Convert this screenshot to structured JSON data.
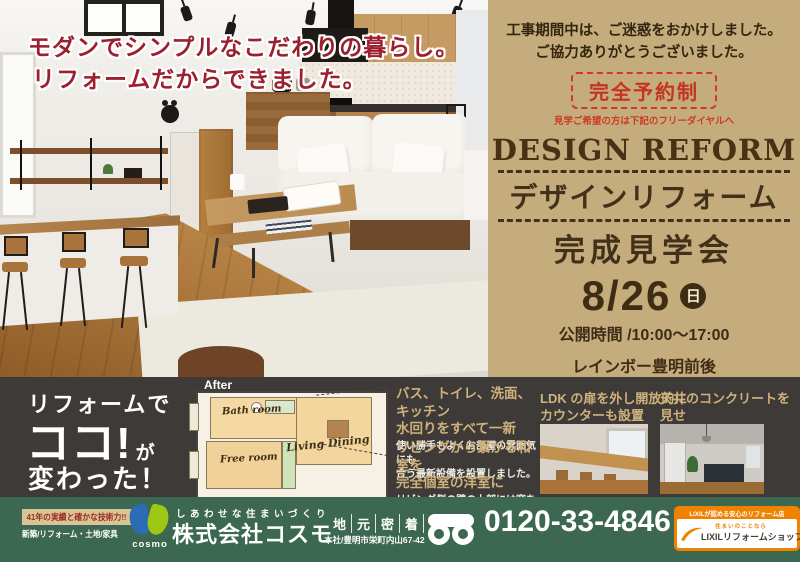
{
  "headline": {
    "line1": "モダンでシンプルなこだわりの暮らし。",
    "line2": "リフォームだからできました。"
  },
  "event_panel": {
    "greeting_line1": "工事期間中は、ご迷惑をおかけしました。",
    "greeting_line2": "ご協力ありがとうございました。",
    "reservation_badge": "完全予約制",
    "reservation_note": "見学ご希望の方は下記のフリーダイヤルへ",
    "title_en": "DESIGN REFORM",
    "title_jp": "デザインリフォーム",
    "event_name": "完成見学会",
    "date": "8/26",
    "day_badge": "日",
    "hours": "公開時間 /10:00～17:00",
    "venue_line1": "レインボー豊明前後",
    "venue_line2": "409 号室",
    "description_line1": "珪藻土や、無垢の床など自然素材をたっぷり使った住まいが",
    "description_line2": "完成しました。クールなコンクリートと温もりのある",
    "description_line3": "自然素材とのコラボレーションでこだわりを実現！"
  },
  "bottom_panel": {
    "catch_line1": "リフォームで",
    "catch_line2": "ココ!",
    "catch_line2_suffix": "が",
    "catch_line3": "変わった！",
    "plan": {
      "after_label": "After",
      "bath": "Bath room",
      "living": "Living Dining",
      "free": "Free room"
    },
    "features": [
      {
        "heading_line1": "バス、トイレ、洗面、キッチン",
        "heading_line2": "水回りをすべて一新",
        "body_line1": "使い勝手もよくお部屋の雰囲気にも",
        "body_line2": "合う最新設備を設置しました。"
      },
      {
        "heading_line1": "リビングから繋がる和室を",
        "heading_line2": "完全個室の洋室に",
        "body_line1": "リビング側の壁の上部には窓を付",
        "body_line2": "け、明るさも確保しています。"
      }
    ],
    "photo_captions": [
      {
        "line1": "LDK の扉を外し開放的に",
        "line2": "カウンターも設置"
      },
      {
        "line1": "天井のコンクリートを見せ",
        "line2": "シンプルな空間に"
      }
    ]
  },
  "footer": {
    "experience_badge": "41年の実績と確かな技術力!!",
    "services": "新築/リフォーム・土地/家具",
    "logo_text": "cosmo",
    "slogan": "しあわせな住まいづくり",
    "company": "株式会社コスモ",
    "locality_chars": [
      "地",
      "元",
      "密",
      "着"
    ],
    "address": "本社/豊明市栄町内山67-42",
    "phone": "0120-33-4846",
    "lixil_header": "LIXILが認める安心のリフォーム店",
    "lixil_sub": "住まいのことなら",
    "lixil_name": "LIXILリフォームショップ"
  },
  "colors": {
    "tan": "#c5ac7c",
    "dark_brown": "#3f2c15",
    "red": "#cf3a23",
    "crimson": "#9c1f2d",
    "panel_dark": "#3e3a37",
    "green": "#3c6750",
    "gold": "#cfb17c",
    "orange": "#ef8200"
  }
}
